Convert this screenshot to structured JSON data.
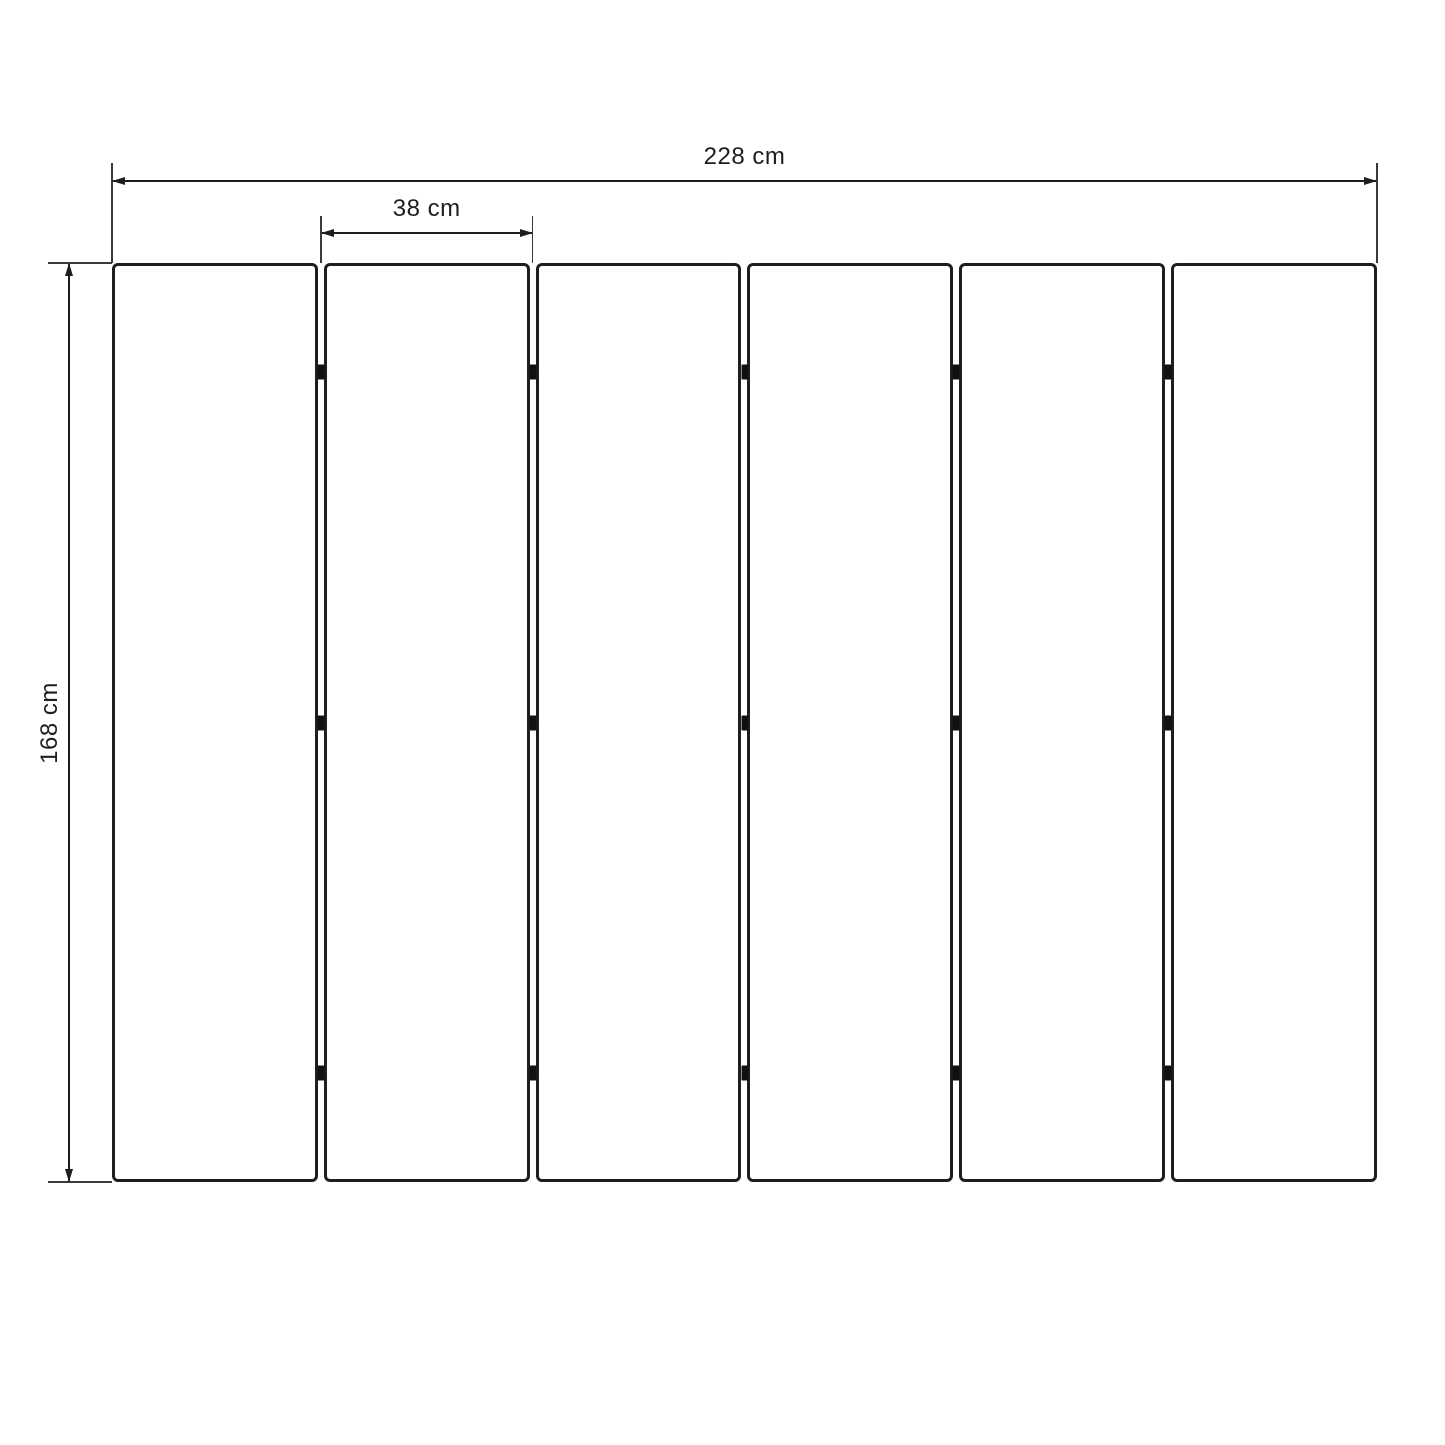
{
  "labels": {
    "total_width": "228 cm",
    "panel_width": "38 cm",
    "height": "168 cm"
  },
  "diagram": {
    "type": "dimensioned-drawing",
    "panel_count": 6,
    "joint_count": 5,
    "connectors_per_joint": 3,
    "connector_positions_pct": [
      11.9,
      50,
      88.1
    ],
    "measurements": {
      "total_width_cm": 228,
      "panel_width_cm": 38,
      "height_cm": 168
    }
  },
  "colors": {
    "ink": "#1e1e1e",
    "extension_line": "#3a3a3a",
    "background": "#ffffff",
    "connector": "#111111"
  }
}
